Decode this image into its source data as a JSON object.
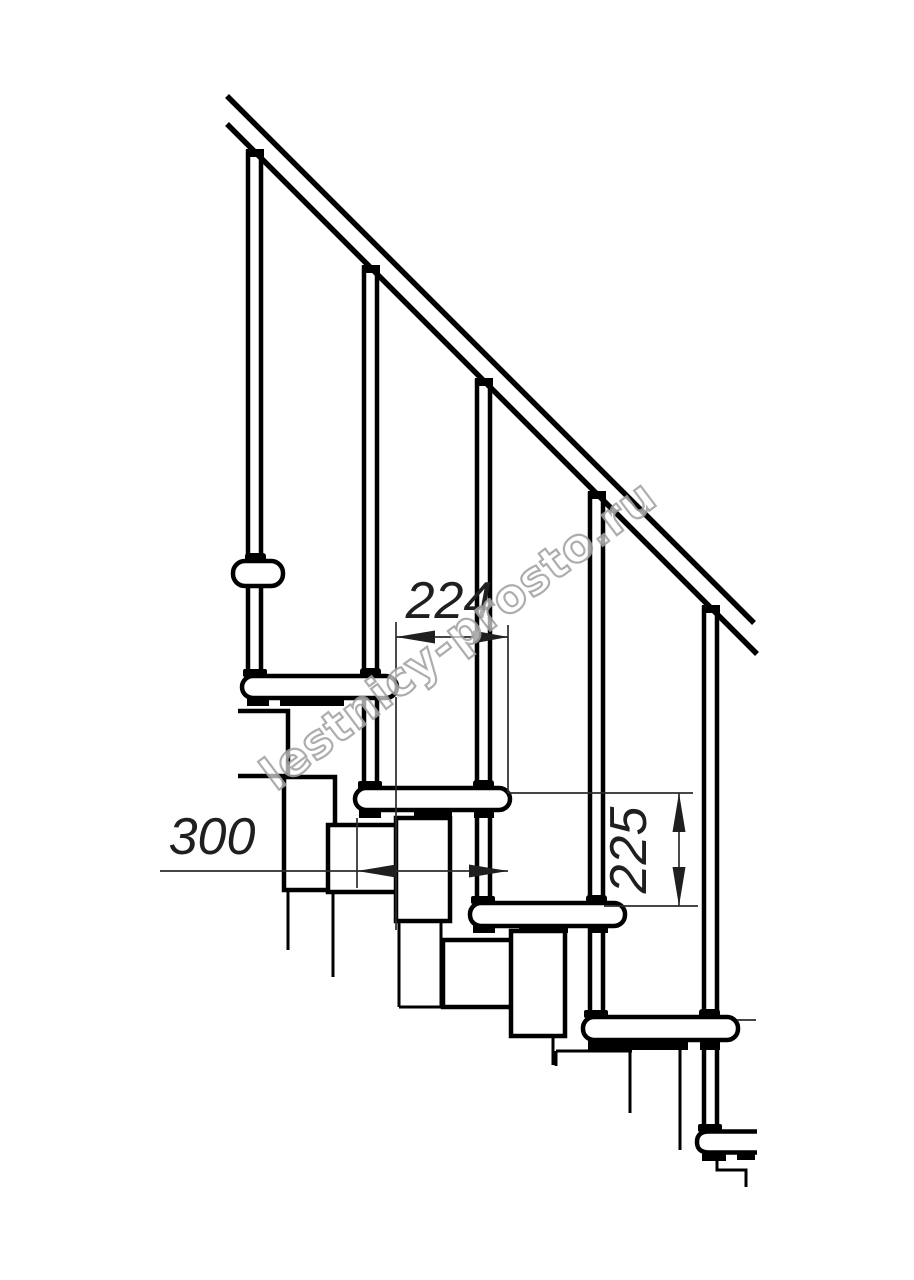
{
  "drawing": {
    "type": "technical-line-drawing",
    "subject": "modular staircase side elevation with handrail and balusters",
    "background_color": "#ffffff",
    "line_color": "#000000",
    "dimension_line_color": "#2b2b2b",
    "units": "mm"
  },
  "dimensions": [
    {
      "id": "step-run",
      "value": "224",
      "orientation": "horizontal",
      "measures": "horizontal distance between consecutive tread noses"
    },
    {
      "id": "tread-depth",
      "value": "300",
      "orientation": "horizontal",
      "measures": "full tread depth"
    },
    {
      "id": "step-rise",
      "value": "225",
      "orientation": "vertical",
      "measures": "rise between consecutive treads"
    }
  ],
  "watermark": {
    "text": "lestnicy-prosto.ru",
    "color": "#a2a2a2"
  },
  "components": {
    "balusters": 5,
    "treads": 5,
    "handrail": 1
  }
}
